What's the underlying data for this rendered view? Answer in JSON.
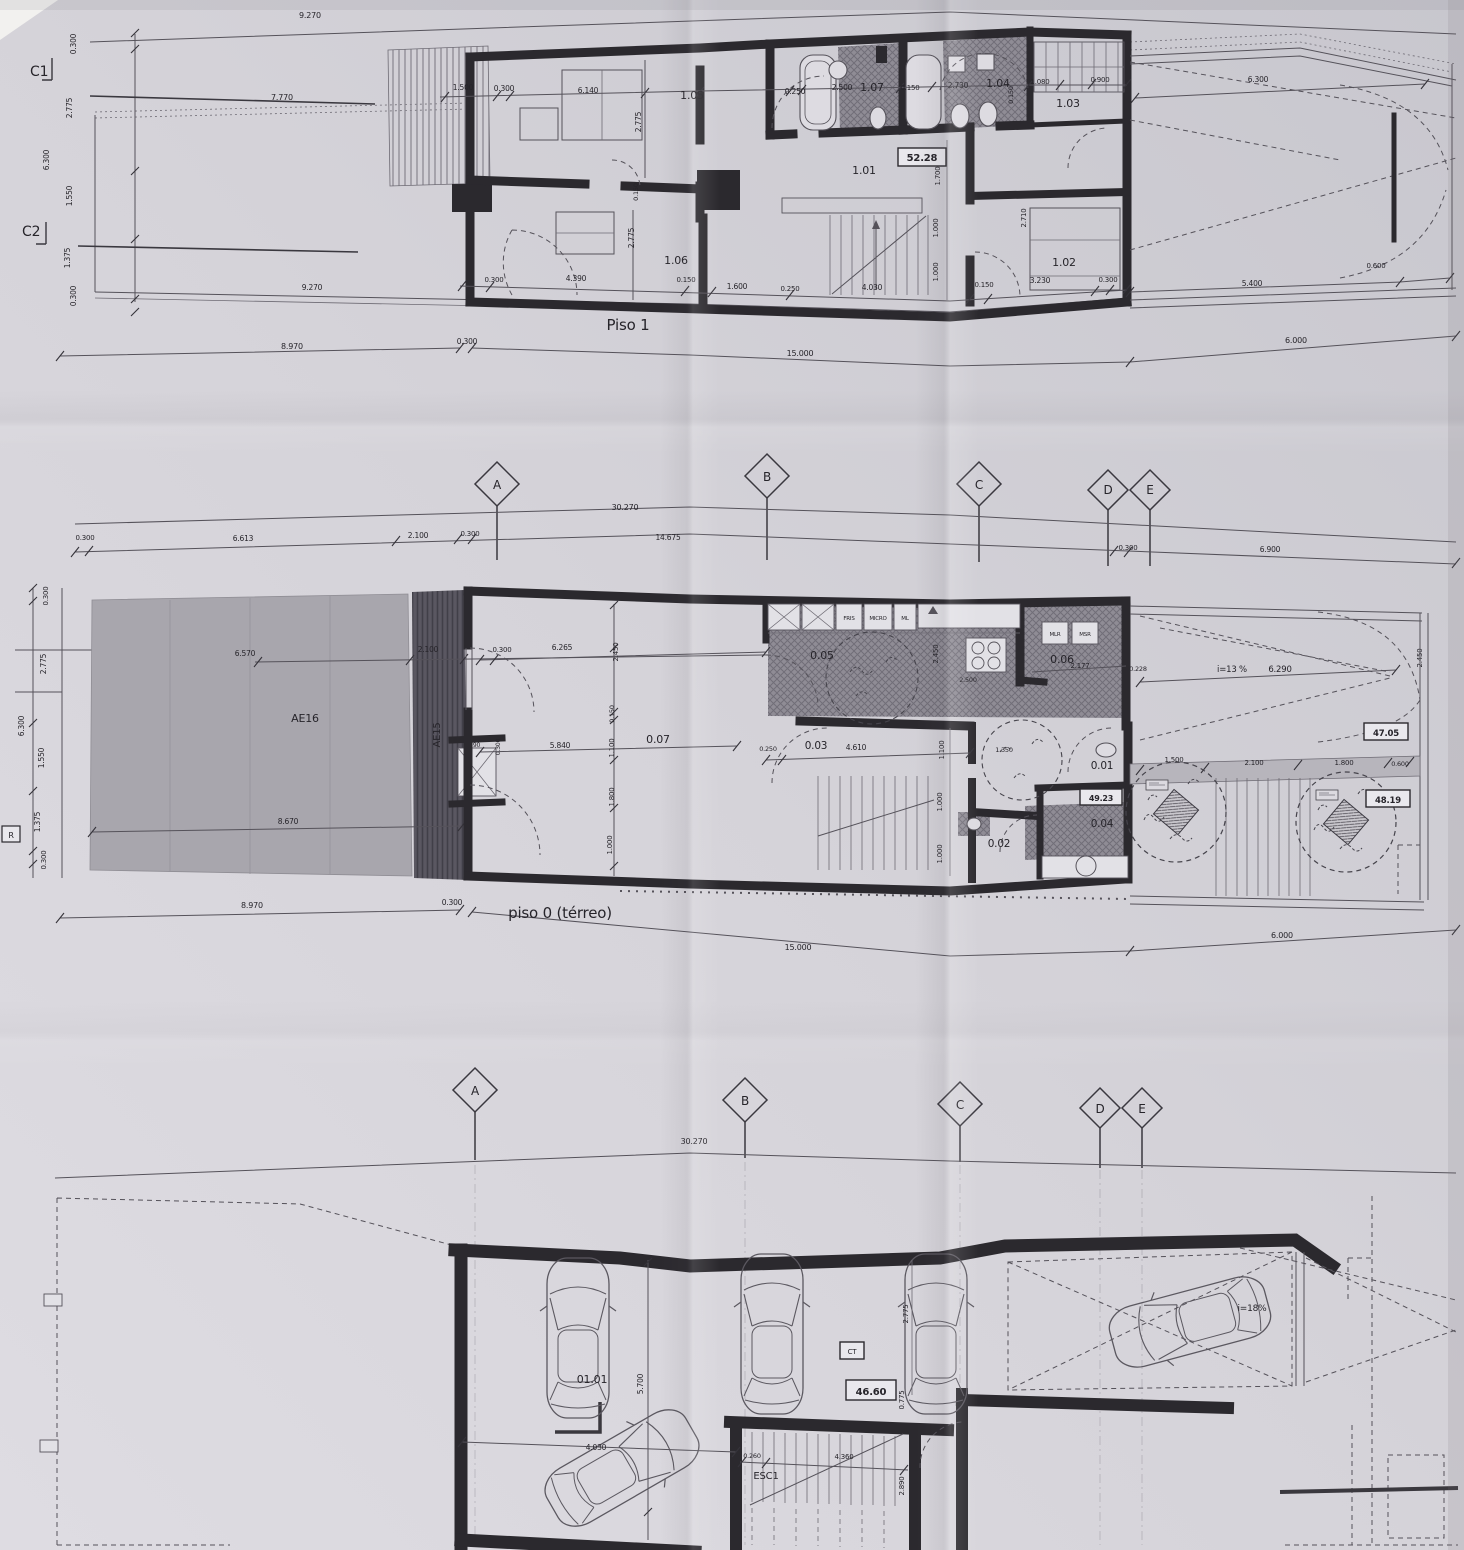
{
  "colors": {
    "paper": "#d6d4da",
    "ink": "#2b292e",
    "thin_line": "#55525a",
    "hatch": "#8f8c95",
    "patio": "#a8a6ad",
    "dark_strip": "#5a5761"
  },
  "gm": {
    "a": "A",
    "b": "B",
    "c": "C",
    "d": "D",
    "e": "E"
  },
  "p1": {
    "title": "Piso 1",
    "c1": "C1",
    "c2": "C2",
    "area": "52.28",
    "rooms": {
      "r101": "1.01",
      "r102": "1.02",
      "r103": "1.03",
      "r104": "1.04",
      "r105": "1.05",
      "r106": "1.06",
      "r107": "1.07"
    },
    "top": {
      "d9270": "9.270",
      "d7770": "7.770",
      "d1500": "1.500",
      "d0300": "0.300",
      "d6140": "6.140",
      "d2775": "2.775",
      "d0250": "0.250",
      "d2500": "2.500",
      "d0150a": "0.150",
      "d2730": "2.730",
      "d0150b": "0.150",
      "d1080": "1.080",
      "d0900": "0.900",
      "d6300": "6.300"
    },
    "left": {
      "d0300t": "0.300",
      "d2775": "2.775",
      "d6300": "6.300",
      "d1550": "1.550",
      "d1375": "1.375",
      "d0300b": "0.300"
    },
    "mid": {
      "d2775": "2.775",
      "d0150": "0.150",
      "d1700": "1.700",
      "d1000a": "1.000",
      "d1000b": "1.000",
      "d2710": "2.710"
    },
    "bottom": {
      "d0300a": "0.300",
      "d4390": "4.390",
      "d0150a": "0.150",
      "d1600": "1.600",
      "d0250": "0.250",
      "d4030": "4.030",
      "d0150b": "0.150",
      "d3230": "3.230",
      "d0300b": "0.300",
      "d5400": "5.400",
      "d0600": "0.600",
      "d9270": "9.270"
    },
    "row2": {
      "d8970": "8.970",
      "d0300": "0.300",
      "d15000": "15.000",
      "d6000": "6.000"
    }
  },
  "p0": {
    "title": "piso 0 (térreo)",
    "r_label": "R",
    "ae16": "AE16",
    "ae15": "AE15",
    "rooms": {
      "r001": "0.01",
      "r002": "0.02",
      "r003": "0.03",
      "r004": "0.04",
      "r005": "0.05",
      "r006": "0.06",
      "r007": "0.07"
    },
    "areas": {
      "a47": "47.05",
      "a48": "48.19",
      "a49": "49.23"
    },
    "appl": {
      "fris": "FRIS",
      "micro": "MICRO",
      "ml": "ML",
      "mlr": "MLR",
      "msr": "MSR"
    },
    "ramp": {
      "slope": "i=13 %",
      "d6290": "6.290"
    },
    "grid": {
      "d30270": "30.270",
      "d0300a": "0.300",
      "d6613": "6.613",
      "d2100": "2.100",
      "d0300b": "0.300",
      "d14675": "14.675",
      "d0300c": "0.300",
      "d6900": "6.900"
    },
    "left": {
      "d0300a": "0.300",
      "d2775": "2.775",
      "d6300": "6.300",
      "d1550": "1.550",
      "d1375": "1.375",
      "d0300b": "0.300"
    },
    "patio": {
      "d6570": "6.570",
      "d2100": "2.100",
      "d8670": "8.670",
      "d4390": "4.390",
      "d0300": "0.300"
    },
    "inner": {
      "d0300": "0.300",
      "d6265": "6.265",
      "d2450a": "2.450",
      "d0150": "0.150",
      "d1100a": "1.100",
      "d1800": "1.800",
      "d1000a": "1.000",
      "d5840": "5.840",
      "d2500": "2.500",
      "d2177": "2.177",
      "d0228": "0.228",
      "d2450b": "2.450",
      "d2450c": "2.450",
      "d0250": "0.250",
      "d4610": "4.610",
      "d1350": "1.350",
      "d1100b": "1.100",
      "d1000b": "1.000",
      "d1000c": "1.000"
    },
    "right": {
      "d1500": "1.500",
      "d2100": "2.100",
      "d1800": "1.800",
      "d0600": "0.600"
    },
    "bottom": {
      "d8970": "8.970",
      "d0300": "0.300",
      "d15000": "15.000",
      "d6000": "6.000"
    }
  },
  "pg": {
    "room": "01.01",
    "esc": "ESC1",
    "area": "46.60",
    "ct": "CT",
    "slope": "i=18%",
    "grid": {
      "d30270": "30.270"
    },
    "dims": {
      "d5700": "5.700",
      "d4030": "4.030",
      "d0260": "0.260",
      "d4360": "4.360",
      "d2890": "2.890",
      "d0775": "0.775",
      "d2775": "2.775"
    }
  }
}
